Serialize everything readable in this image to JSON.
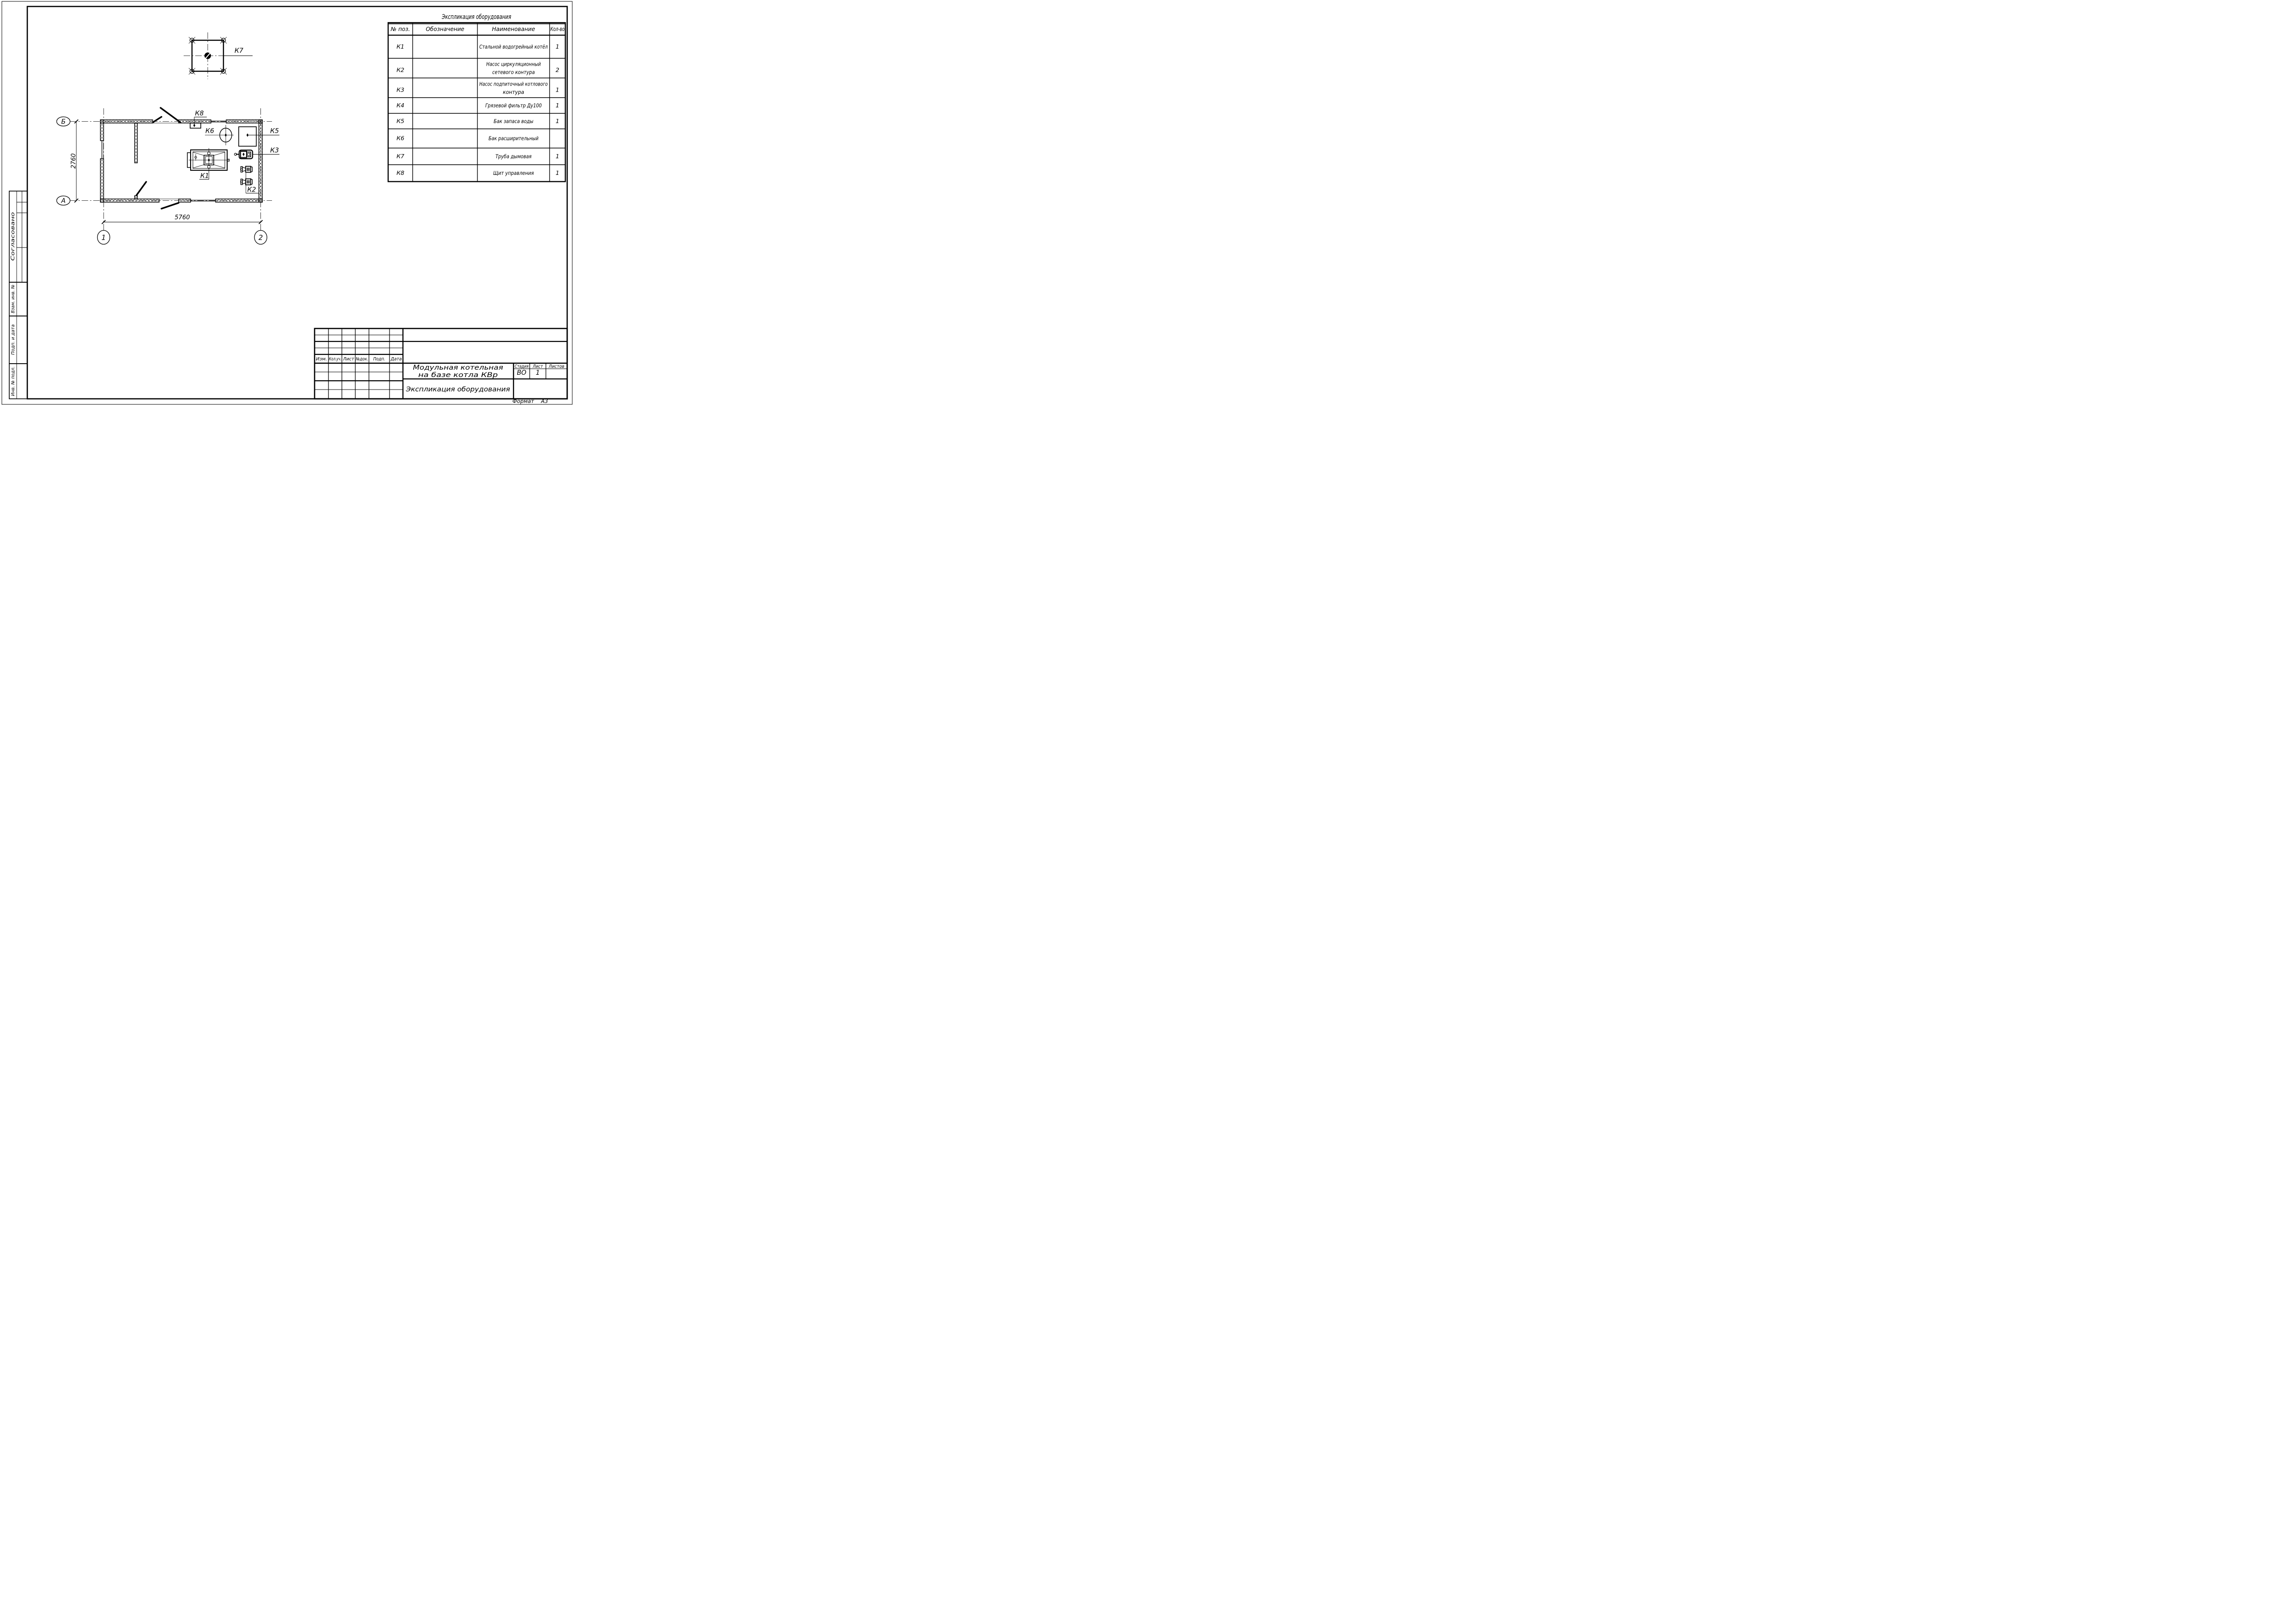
{
  "equipment_table": {
    "title": "Экспликация оборудования",
    "headers": {
      "pos": "№ поз.",
      "designation": "Обозначение",
      "name": "Наименование",
      "qty": "Кол-во"
    },
    "rows": [
      {
        "pos": "К1",
        "name1": "Стальной водогрейный котёл",
        "name2": "",
        "qty": "1"
      },
      {
        "pos": "К2",
        "name1": "Насос циркуляционный",
        "name2": "сетевого контура",
        "qty": "2"
      },
      {
        "pos": "К3",
        "name1": "Насос подпиточный котлового",
        "name2": "контура",
        "qty": "1"
      },
      {
        "pos": "К4",
        "name1": "Грязевой фильтр Ду100",
        "name2": "",
        "qty": "1"
      },
      {
        "pos": "К5",
        "name1": "Бак запаса воды",
        "name2": "",
        "qty": "1"
      },
      {
        "pos": "К6",
        "name1": "Бак расширительный",
        "name2": "",
        "qty": ""
      },
      {
        "pos": "К7",
        "name1": "Труба дымовая",
        "name2": "",
        "qty": "1"
      },
      {
        "pos": "К8",
        "name1": "Щит управления",
        "name2": "",
        "qty": "1"
      }
    ]
  },
  "plan": {
    "labels": {
      "k1": "К1",
      "k2": "К2",
      "k3": "К3",
      "k5": "К5",
      "k6": "К6",
      "k7": "К7",
      "k8": "К8"
    },
    "axes": {
      "top": "Б",
      "bottom": "А",
      "left": "1",
      "right": "2"
    },
    "dims": {
      "width": "5760",
      "height": "2760"
    }
  },
  "stamp": {
    "change_cols": [
      "Изм.",
      "Кол.уч.",
      "Лист",
      "№док.",
      "Подп.",
      "Дата"
    ],
    "project_line1": "Модульная котельная",
    "project_line2": "на базе котла КВр",
    "doc_title": "Экспликация оборудования",
    "stage_label": "Стадия",
    "sheet_label": "Лист",
    "sheets_label": "Листов",
    "stage_value": "ВО",
    "sheet_value": "1",
    "sheets_value": ""
  },
  "side_strip": {
    "agreed": "Согласовано",
    "replace_inv": "Взам. инв. №",
    "sign_date": "Подп. и дата",
    "inv_orig": "Инв. № подл."
  },
  "footer": {
    "format_label": "Формат",
    "format_value": "А3"
  }
}
